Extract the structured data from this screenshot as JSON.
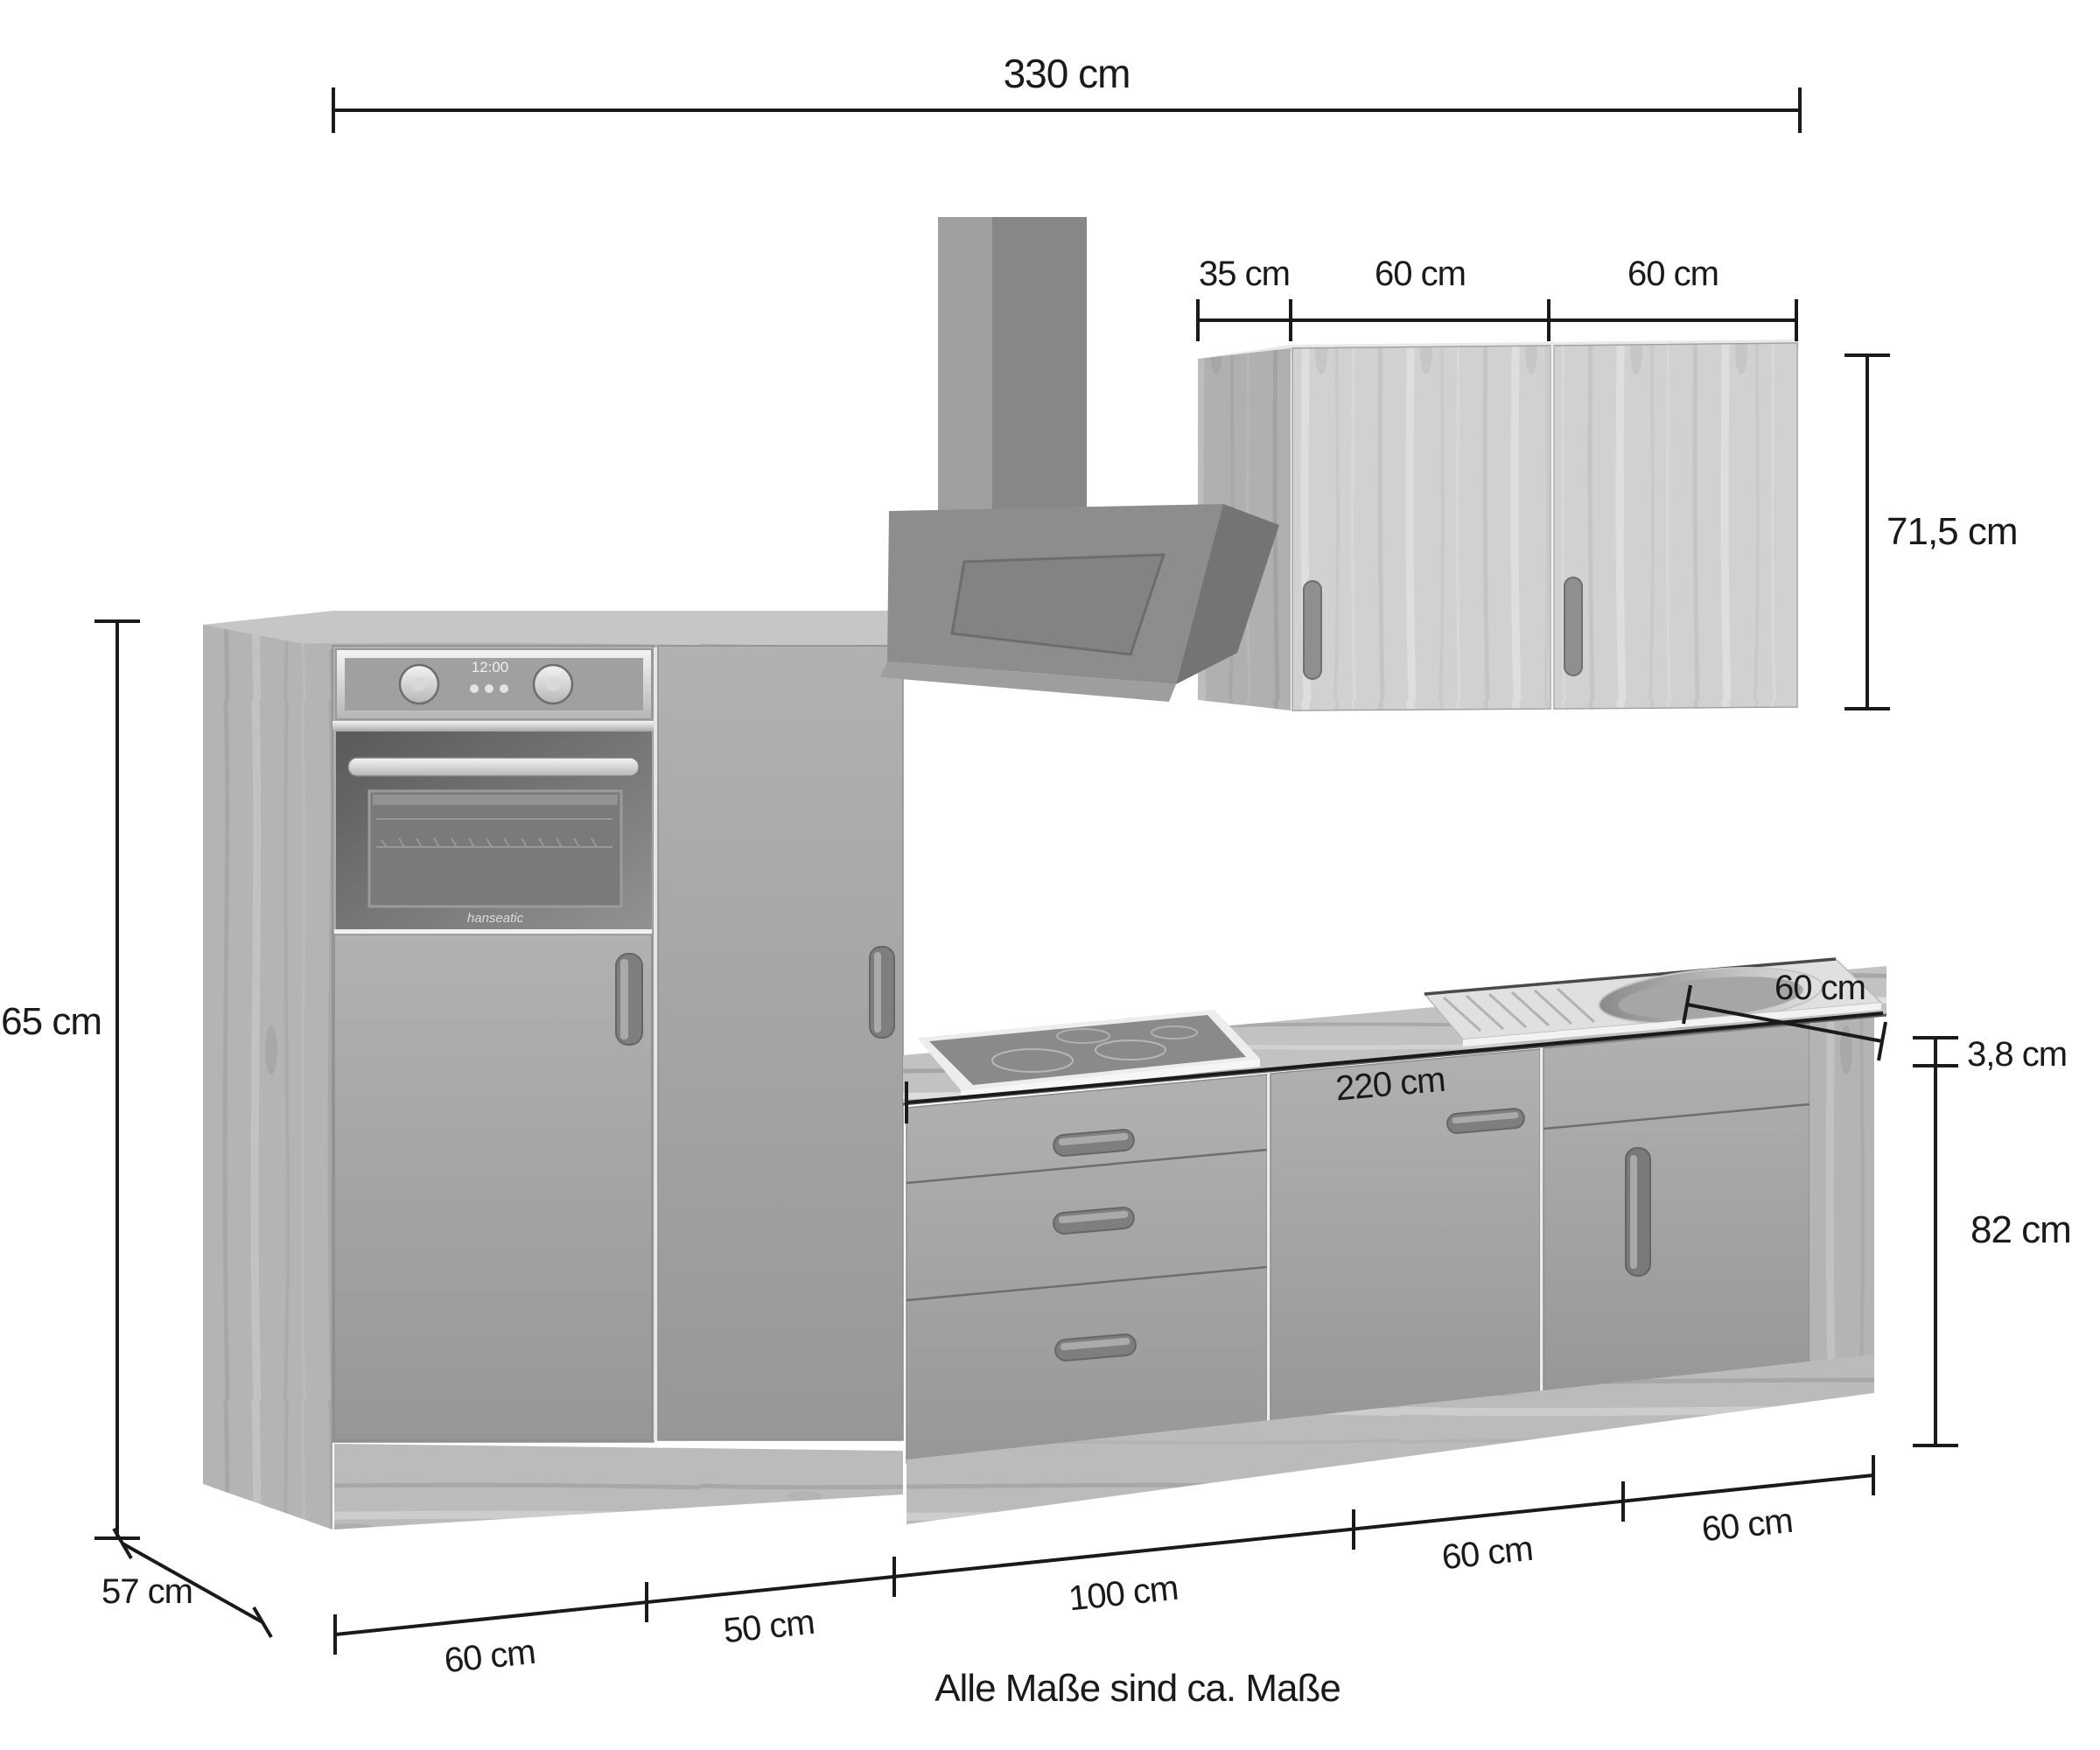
{
  "note": "Alle Maße sind ca. Maße",
  "appliance": {
    "brand": "hanseatic",
    "clock": "12:00"
  },
  "dims": {
    "total_width": "330 cm",
    "wall_depth": "35 cm",
    "wall_door_left": "60 cm",
    "wall_door_right": "60 cm",
    "wall_height": "71,5 cm",
    "total_height": "165 cm",
    "unit_depth": "57 cm",
    "oven_unit_width": "60 cm",
    "tall_unit_width": "50 cm",
    "drawer_unit_width": "100 cm",
    "middle_unit_width": "60 cm",
    "sink_unit_width": "60 cm",
    "worktop_run": "220 cm",
    "worktop_depth": "60 cm",
    "worktop_thickness": "3,8 cm",
    "base_body_height": "82 cm"
  },
  "colors": {
    "dimension_line": "#1a1a1a",
    "front_grey": "#a3a3a3",
    "wood_light": "#c9c9c9",
    "hood_grey": "#8d8d8d",
    "background": "#ffffff"
  }
}
